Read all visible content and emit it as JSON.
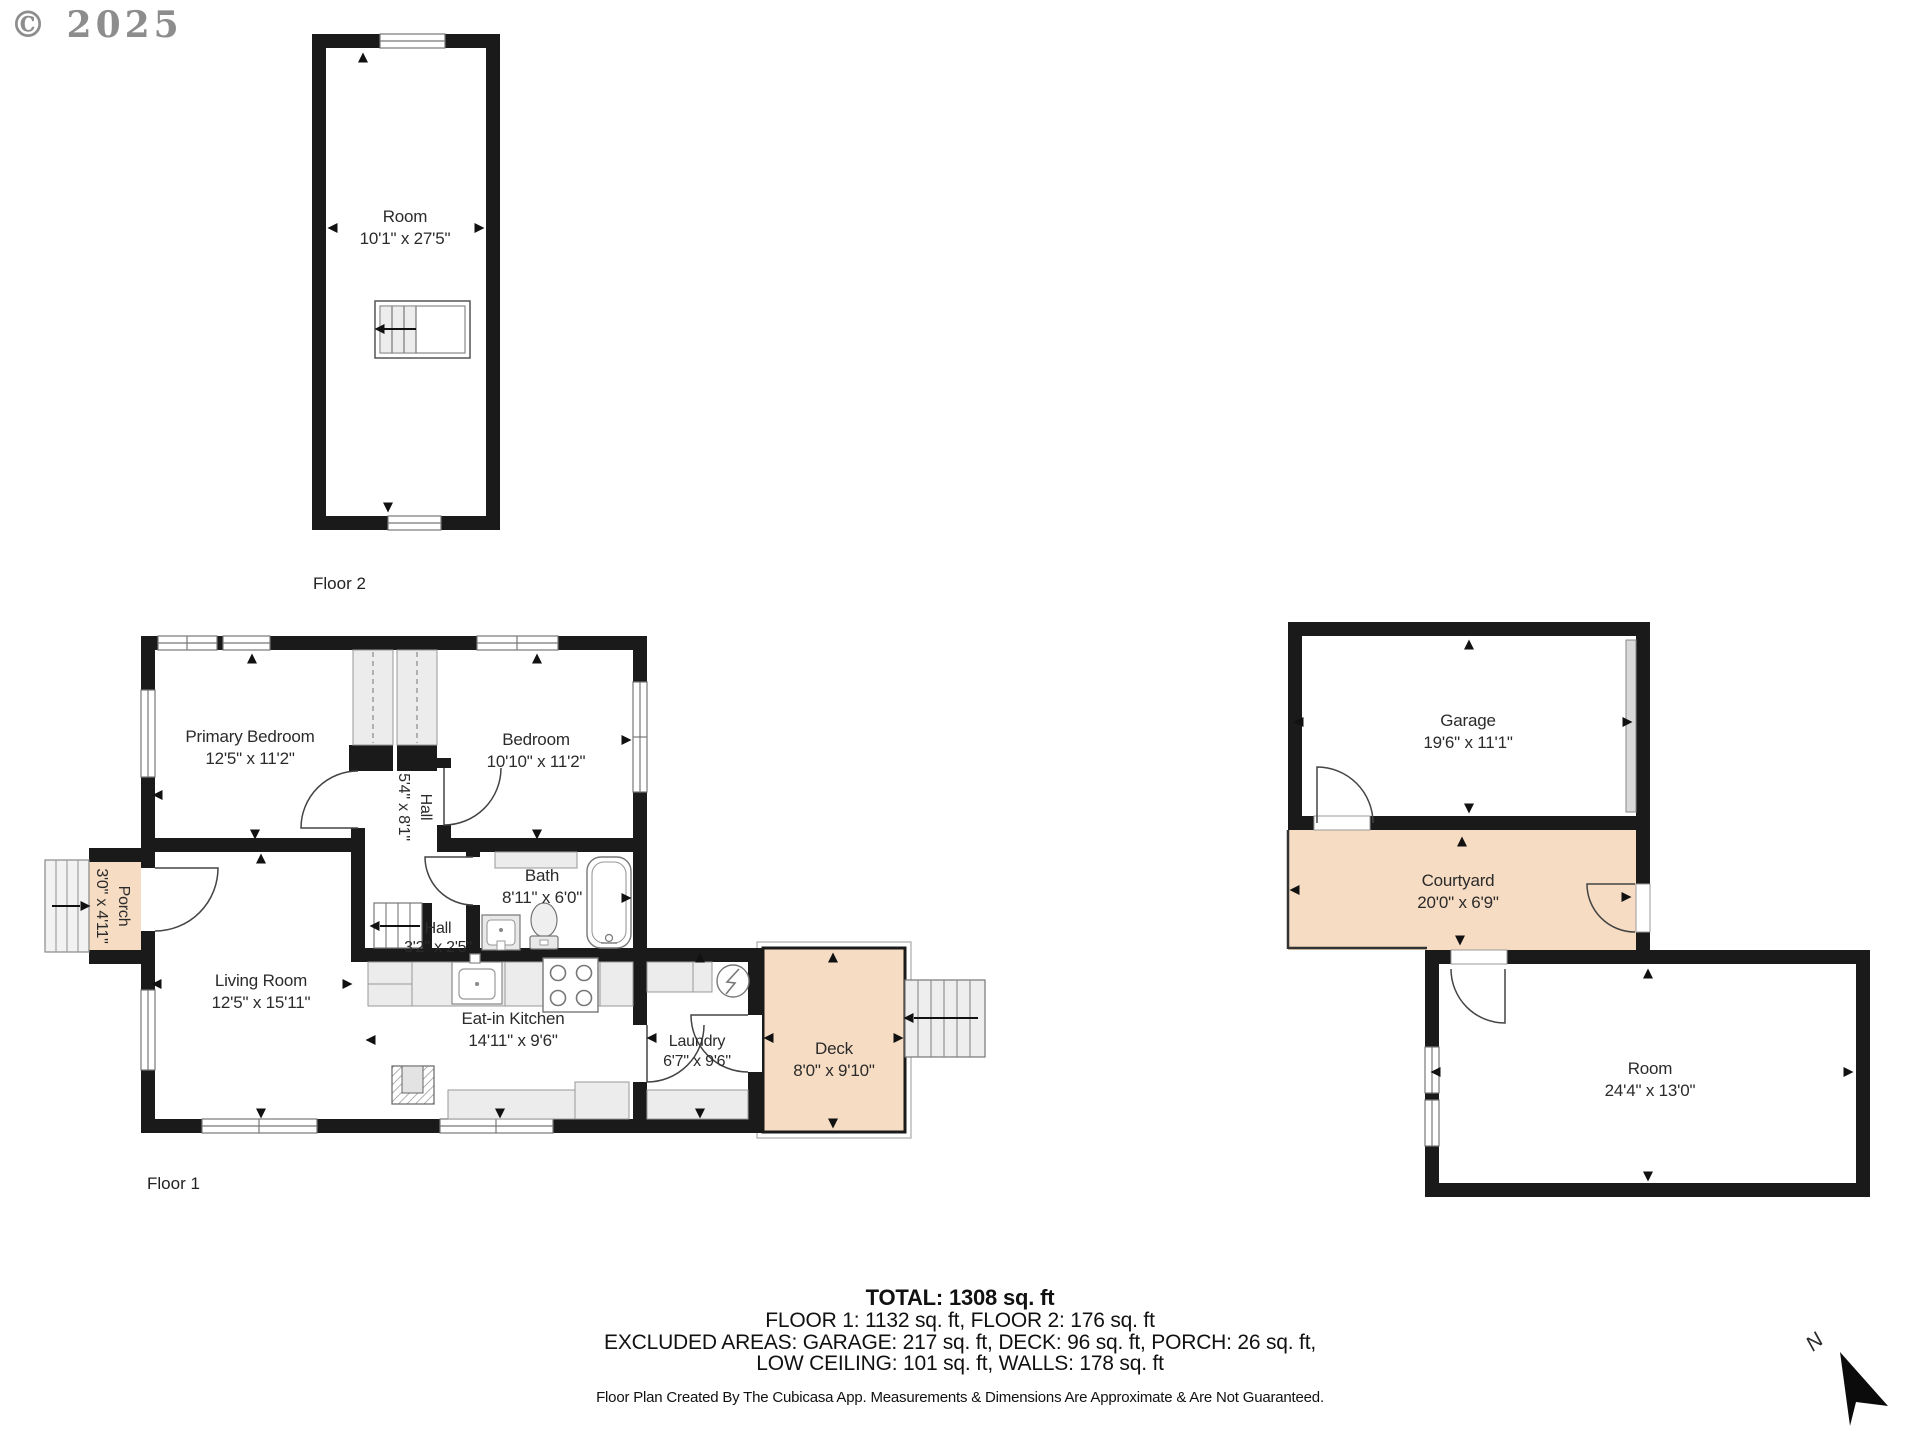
{
  "watermark": "© 2025",
  "floor1": {
    "label": "Floor 1",
    "primary_bedroom": {
      "name": "Primary Bedroom",
      "dims": "12'5\" x 11'2\""
    },
    "bedroom": {
      "name": "Bedroom",
      "dims": "10'10\" x 11'2\""
    },
    "hall_upper": {
      "name": "Hall",
      "dims": "5'4\" x 8'1\""
    },
    "bath": {
      "name": "Bath",
      "dims": "8'11\" x 6'0\""
    },
    "hall_lower": {
      "name": "Hall",
      "dims": "3'2\" x 2'5\""
    },
    "living_room": {
      "name": "Living Room",
      "dims": "12'5\" x 15'11\""
    },
    "kitchen": {
      "name": "Eat-in Kitchen",
      "dims": "14'11\" x 9'6\""
    },
    "laundry": {
      "name": "Laundry",
      "dims": "6'7\" x 9'6\""
    },
    "deck": {
      "name": "Deck",
      "dims": "8'0\" x 9'10\""
    },
    "porch": {
      "name": "Porch",
      "dims": "3'0\" x 4'11\""
    }
  },
  "floor2": {
    "label": "Floor 2",
    "room": {
      "name": "Room",
      "dims": "10'1\" x 27'5\""
    }
  },
  "outbuilding": {
    "garage": {
      "name": "Garage",
      "dims": "19'6\" x 11'1\""
    },
    "courtyard": {
      "name": "Courtyard",
      "dims": "20'0\" x 6'9\""
    },
    "room": {
      "name": "Room",
      "dims": "24'4\" x 13'0\""
    }
  },
  "summary": {
    "total": "TOTAL: 1308 sq. ft",
    "floors": "FLOOR 1: 1132 sq. ft, FLOOR 2: 176 sq. ft",
    "excluded": "EXCLUDED AREAS: GARAGE: 217 sq. ft, DECK: 96 sq. ft, PORCH: 26 sq. ft,",
    "low_ceiling": "LOW CEILING: 101 sq. ft, WALLS: 178 sq. ft",
    "disclaimer": "Floor Plan Created By The Cubicasa App. Measurements & Dimensions Are Approximate & Are Not Guaranteed."
  },
  "compass": {
    "label": "N"
  },
  "colors": {
    "wall": "#1a1a1a",
    "outdoor_fill": "#f6dcc2",
    "fixture_fill": "#ececec",
    "watermark_gray": "#8d8d8d"
  }
}
